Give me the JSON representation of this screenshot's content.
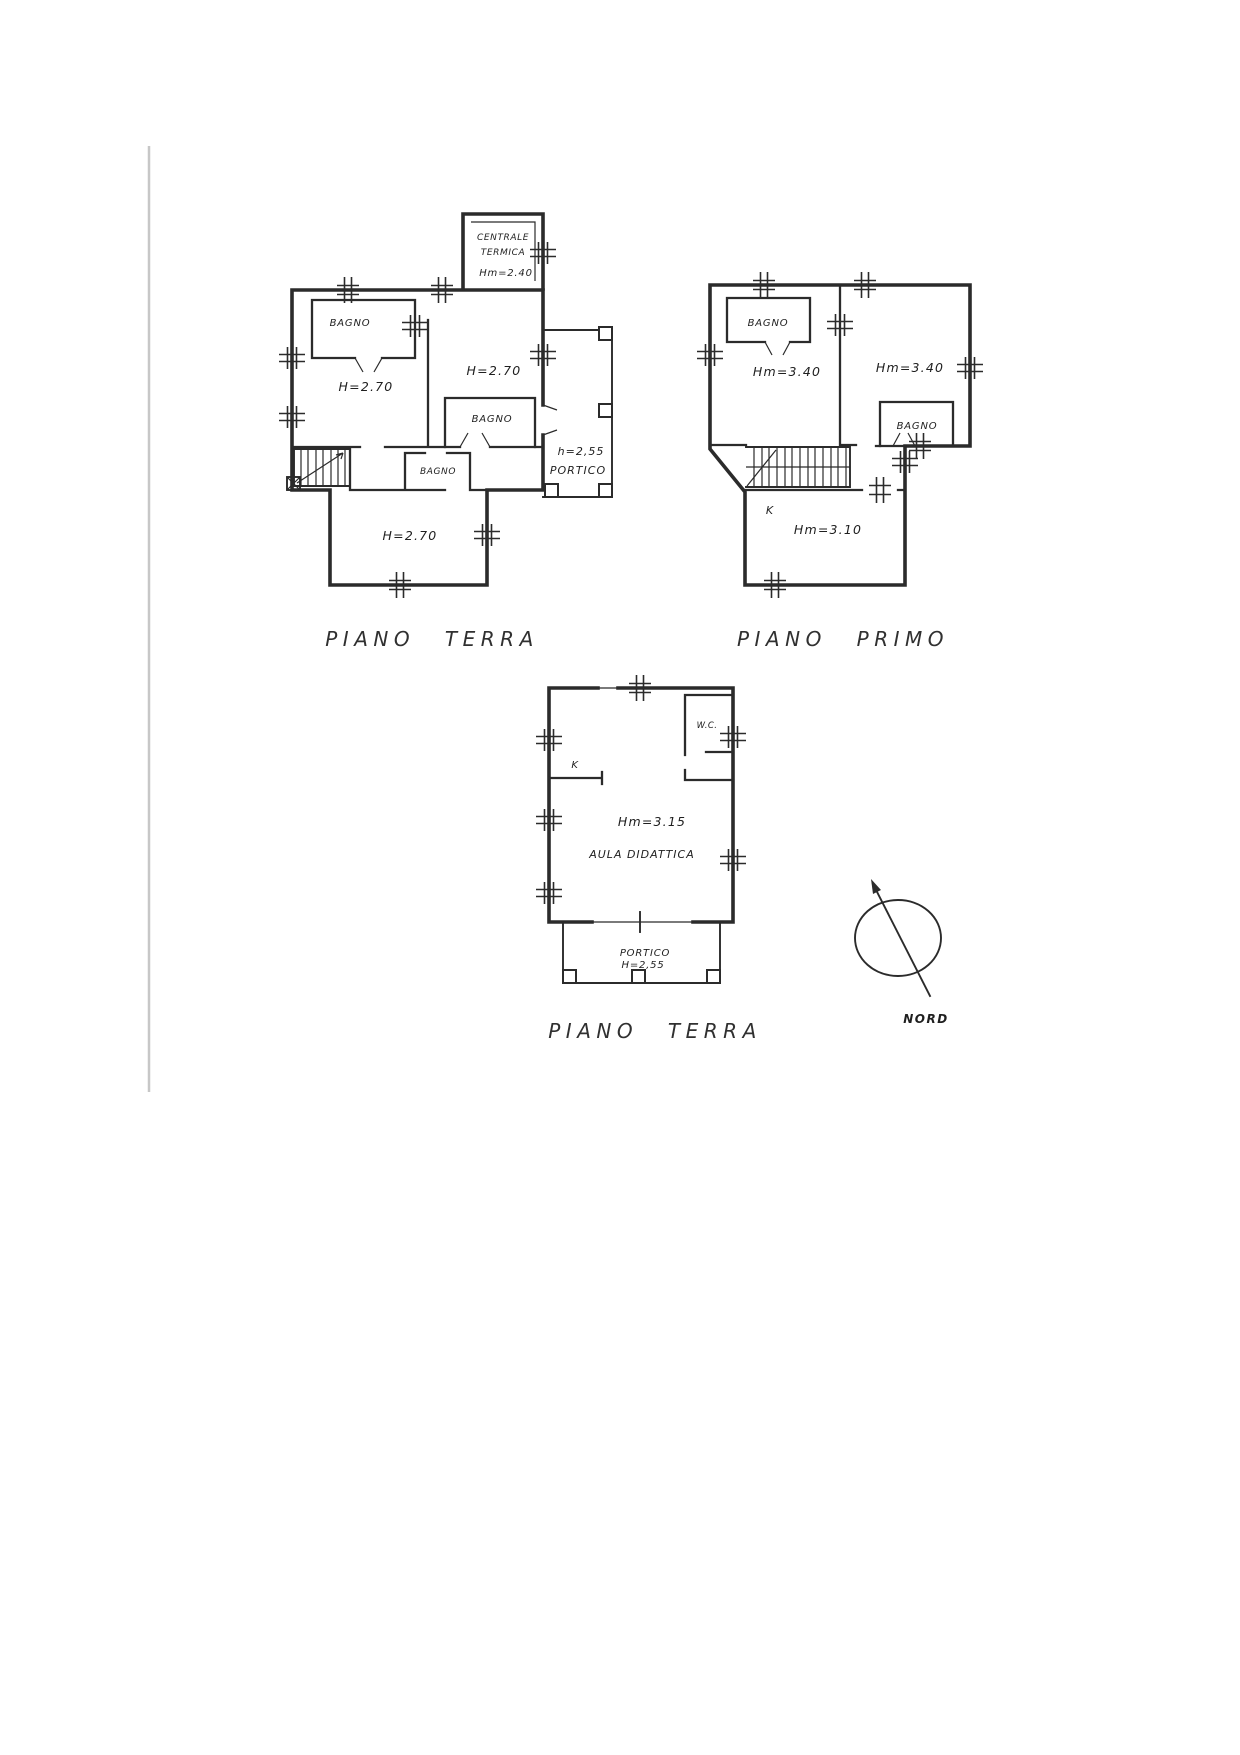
{
  "plans": [
    {
      "caption": "PIANO TERRA",
      "labels": {
        "centrale_line1": "CENTRALE",
        "centrale_line2": "TERMICA",
        "centrale_h": "Hm=2.40",
        "bagno_nw": "BAGNO",
        "room_w": "H=2.70",
        "room_e": "H=2.70",
        "bagno_e": "BAGNO",
        "bagno_mid": "BAGNO",
        "room_s": "H=2.70",
        "portico_h": "h=2,55",
        "portico": "PORTICO"
      }
    },
    {
      "caption": "PIANO PRIMO",
      "labels": {
        "bagno_w": "BAGNO",
        "room_w": "Hm=3.40",
        "room_e": "Hm=3.40",
        "bagno_e": "BAGNO",
        "kitchen": "K",
        "room_s": "Hm=3.10"
      }
    },
    {
      "caption": "PIANO TERRA",
      "labels": {
        "wc": "W.C.",
        "kitchen": "K",
        "room_h": "Hm=3.15",
        "room_name": "AULA DIDATTICA",
        "portico": "PORTICO",
        "portico_h": "H=2,55"
      }
    }
  ],
  "compass": {
    "label": "NORD"
  },
  "ink": "#2b2b2b"
}
